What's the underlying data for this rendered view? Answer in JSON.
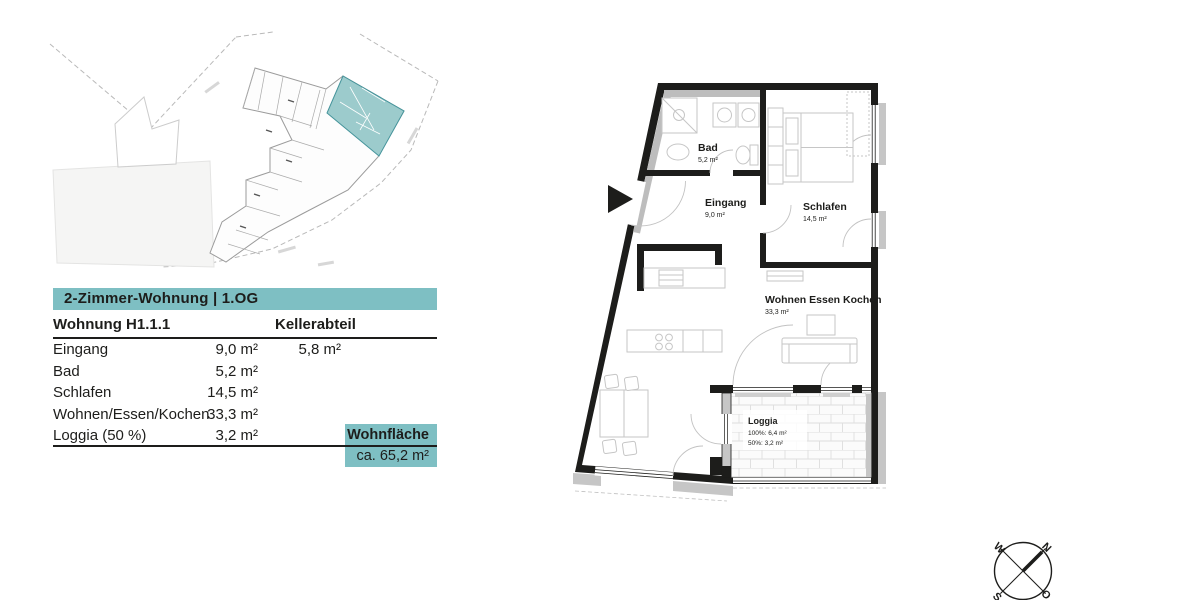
{
  "colors": {
    "accent_teal": "#7EBFC3",
    "site_plan_unit_teal": "#9CCBCC",
    "wall_black": "#1d1d1b",
    "furniture_gray": "#c6c6c6"
  },
  "unit_info": {
    "title": "2-Zimmer-Wohnung | 1.OG",
    "unit_label": "Wohnung H1.1.1",
    "basement_label": "Kellerabteil",
    "rows": [
      {
        "label": "Eingang",
        "area": "9,0 m²",
        "keller": "5,8 m²"
      },
      {
        "label": "Bad",
        "area": "5,2 m²",
        "keller": ""
      },
      {
        "label": "Schlafen",
        "area": "14,5 m²",
        "keller": ""
      },
      {
        "label": "Wohnen/Essen/Kochen",
        "area": "33,3 m²",
        "keller": ""
      },
      {
        "label": "Loggia (50 %)",
        "area": "3,2 m²",
        "keller": ""
      }
    ],
    "total_label": "Wohnfläche",
    "total_value": "ca. 65,2 m²"
  },
  "floor_plan": {
    "bad": {
      "name": "Bad",
      "area": "5,2 m²"
    },
    "eingang": {
      "name": "Eingang",
      "area": "9,0 m²"
    },
    "schlafen": {
      "name": "Schlafen",
      "area": "14,5 m²"
    },
    "wohnen": {
      "name": "Wohnen Essen Kochen",
      "area": "33,3 m²"
    },
    "loggia": {
      "name": "Loggia",
      "area_100": "100%: 6,4 m²",
      "area_50": "50%: 3,2 m²"
    }
  },
  "compass": {
    "n": "N",
    "o": "O",
    "s": "S",
    "w": "W"
  }
}
